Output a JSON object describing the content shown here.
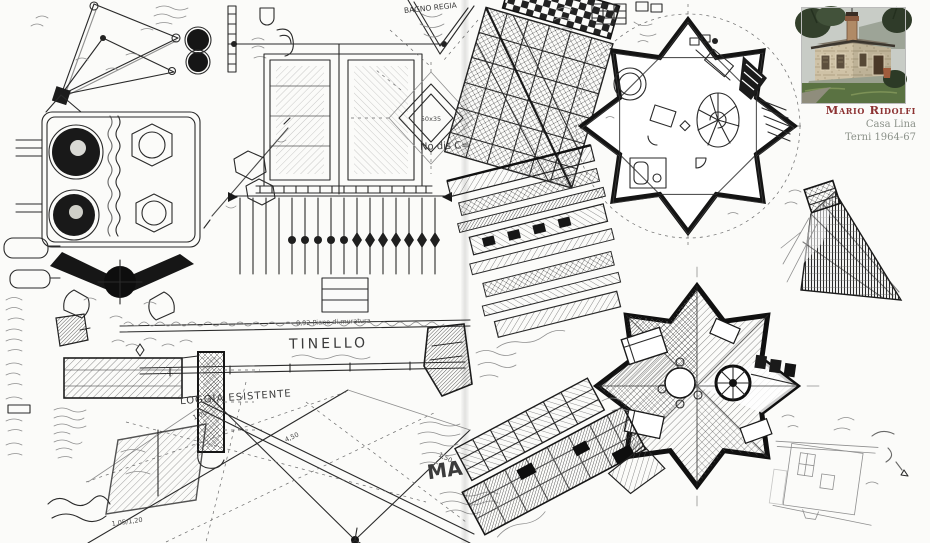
{
  "colors": {
    "accent": "#8c3232",
    "muted": "#8b9189",
    "ink": "#222222"
  },
  "caption": {
    "architect": "Mario Ridolfi",
    "project": "Casa Lina",
    "dates": "Terni 1964-67"
  },
  "annotations": {
    "bagno_regia": "BAGNO REGIA",
    "no_dis": "No dis C=",
    "diamond_size": "50x35",
    "piano_note": "0,92 Piano di muratura",
    "tinello": "TINELLO",
    "loggia": "LOGGIA ESISTENTE",
    "ma": "MA",
    "dim_1": "4,50",
    "dim_2": "1,00",
    "dim_3": "1,05/1,20",
    "dim_4": "1,50"
  }
}
